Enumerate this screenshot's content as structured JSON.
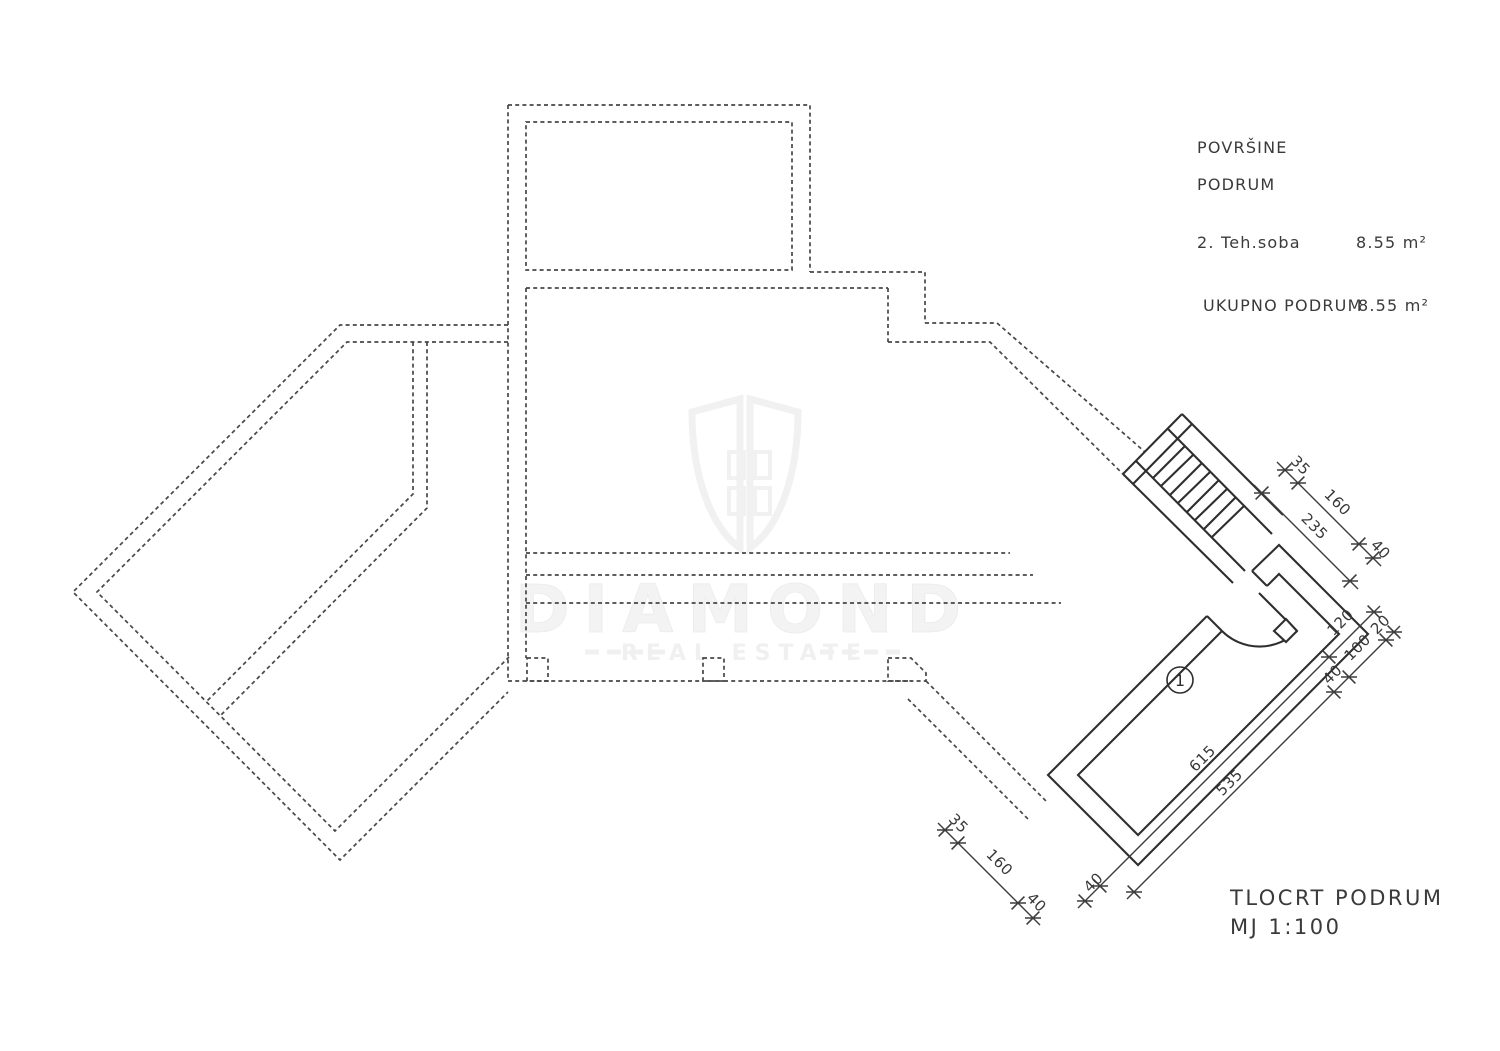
{
  "legend": {
    "title": "POVRŠINE",
    "floor": "PODRUM",
    "rows": [
      {
        "label": "2. Teh.soba",
        "value": "8.55 m²"
      }
    ],
    "total_label": "UKUPNO  PODRUM",
    "total_value": "8.55 m²"
  },
  "title_block": {
    "name": "TLOCRT  PODRUM",
    "scale": "MJ  1:100"
  },
  "room_marker": "1",
  "watermark": {
    "brand": "DIAMOND",
    "tagline": "REAL ESTATE"
  },
  "dimensions": {
    "stair_top": {
      "seg35": "35",
      "seg160": "160",
      "seg40": "40",
      "total": "235"
    },
    "door": {
      "seg120": "120",
      "seg100": "100",
      "seg20": "20",
      "seg40": "40"
    },
    "room_length": {
      "outer": "615",
      "inner": "535",
      "end40": "40"
    },
    "stair_bottom": {
      "seg35": "35",
      "seg160": "160",
      "seg40": "40"
    }
  },
  "colors": {
    "wall_dashed": "#474747",
    "wall_solid": "#2e2e2e",
    "text": "#3a3a3a",
    "watermark": "#f1f1f1",
    "background": "#ffffff"
  }
}
